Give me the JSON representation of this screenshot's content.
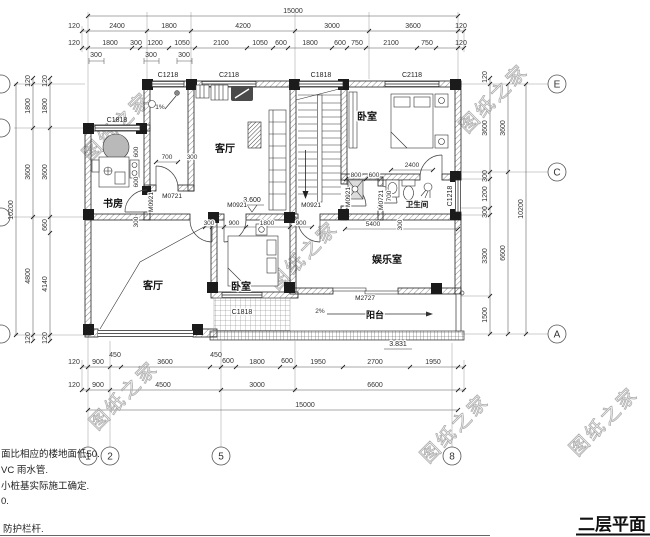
{
  "title": "二层平面",
  "watermark": {
    "text": "图纸之家"
  },
  "rooms": {
    "study": "书房",
    "living_upper": "客厅",
    "bedroom_upper": "卧室",
    "bath": "卫生间",
    "living_lower": "客厅",
    "bedroom_lower": "卧室",
    "entertainment": "娱乐室",
    "balcony": "阳台"
  },
  "levels": {
    "floor": "3.600",
    "balcony": "3.831"
  },
  "slopes": {
    "bath": "1%",
    "balcony": "2%"
  },
  "windows": {
    "study": "C1818",
    "top1": "C1218",
    "top2": "C2118",
    "top3": "C1818",
    "top4": "C2118",
    "right": "C1218",
    "bedroom_lower": "C1818"
  },
  "doors": {
    "tlroom": "M0721",
    "study": "M0921",
    "hall_a": "M0921",
    "hall_b": "M0921",
    "alcove": "M0921",
    "bath": "M0721",
    "balcony": "M2727"
  },
  "grid": {
    "cols": [
      "1",
      "2",
      "5",
      "8"
    ],
    "rows": [
      "E",
      "C",
      "A"
    ]
  },
  "dims": {
    "top1": "15000",
    "top2": [
      "120",
      "2400",
      "1800",
      "4200",
      "3000",
      "3600",
      "120"
    ],
    "top3": [
      "120",
      "1800",
      "300",
      "1200",
      "1050",
      "2100",
      "1050",
      "600",
      "1800",
      "600",
      "750",
      "2100",
      "750",
      "120"
    ],
    "top3_sub": [
      "300",
      "300",
      "300"
    ],
    "bot1": [
      "120",
      "900",
      "450",
      "3600",
      "450",
      "600",
      "1800",
      "600",
      "1950",
      "2700",
      "1950"
    ],
    "bot2": [
      "120",
      "900",
      "4500",
      "3000",
      "6600"
    ],
    "bot3": "15000",
    "left_outer": [
      "120",
      "1800",
      "3600",
      "4800",
      "120"
    ],
    "left_inner": [
      "120",
      "1800",
      "3600",
      "660",
      "4140",
      "120"
    ],
    "left_total": "10200",
    "right_inner": [
      "120",
      "3600",
      "300",
      "1200",
      "300",
      "3300",
      "1500"
    ],
    "right_mid": [
      "3600",
      "6600"
    ],
    "right_total": "10200",
    "interior": {
      "door700": "700",
      "i300a": "300",
      "v600a": "600",
      "v600b": "600",
      "v300": "300",
      "hall300": "300",
      "hall900a": "900",
      "hall1800": "1800",
      "hall900b": "900",
      "i5400": "5400",
      "v300b": "300",
      "i800": "800",
      "i600": "600",
      "bath700": "700",
      "bed2400": "2400"
    }
  },
  "notes": [
    "面比相应的楼地面低50.",
    "VC 雨水管.",
    "小桩基实际施工确定.",
    "0.",
    "防护栏杆."
  ]
}
